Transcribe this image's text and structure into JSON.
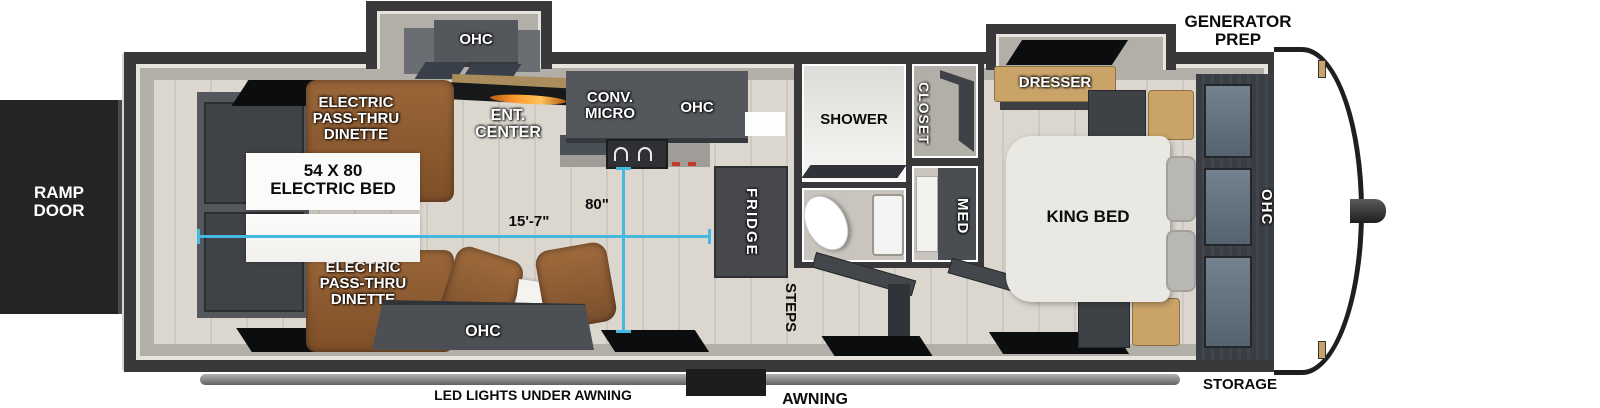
{
  "exterior": {
    "generator_prep": [
      "GENERATOR",
      "PREP"
    ],
    "ramp_door": [
      "RAMP",
      "DOOR"
    ],
    "storage": "STORAGE",
    "awning": "AWNING",
    "led_lights": "LED LIGHTS UNDER AWNING"
  },
  "dimensions": {
    "interior_length": "15'-7\"",
    "interior_width": "80\""
  },
  "garage": {
    "dinette": [
      "ELECTRIC",
      "PASS-THRU",
      "DINETTE"
    ],
    "bed": [
      "54 X 80",
      "ELECTRIC BED"
    ],
    "rear_ohc": "OHC",
    "sofa_ohc": "OHC",
    "ent_center": [
      "ENT.",
      "CENTER"
    ]
  },
  "kitchen": {
    "conv_micro": [
      "CONV.",
      "MICRO"
    ],
    "ohc": "OHC",
    "fridge": "FRIDGE"
  },
  "bath": {
    "shower": "SHOWER",
    "closet": "CLOSET",
    "med": "MED"
  },
  "entry": {
    "steps": "STEPS"
  },
  "bedroom": {
    "dresser": "DRESSER",
    "king_bed": "KING BED",
    "ohc": "OHC"
  },
  "colors": {
    "wall": "#39393b",
    "floor": "#d9d5ce",
    "dimension_accent": "#45b9e0",
    "dinette_brown": "#8b5a34",
    "wood_tan": "#c9a368",
    "cabinet_gray": "#54575c"
  }
}
